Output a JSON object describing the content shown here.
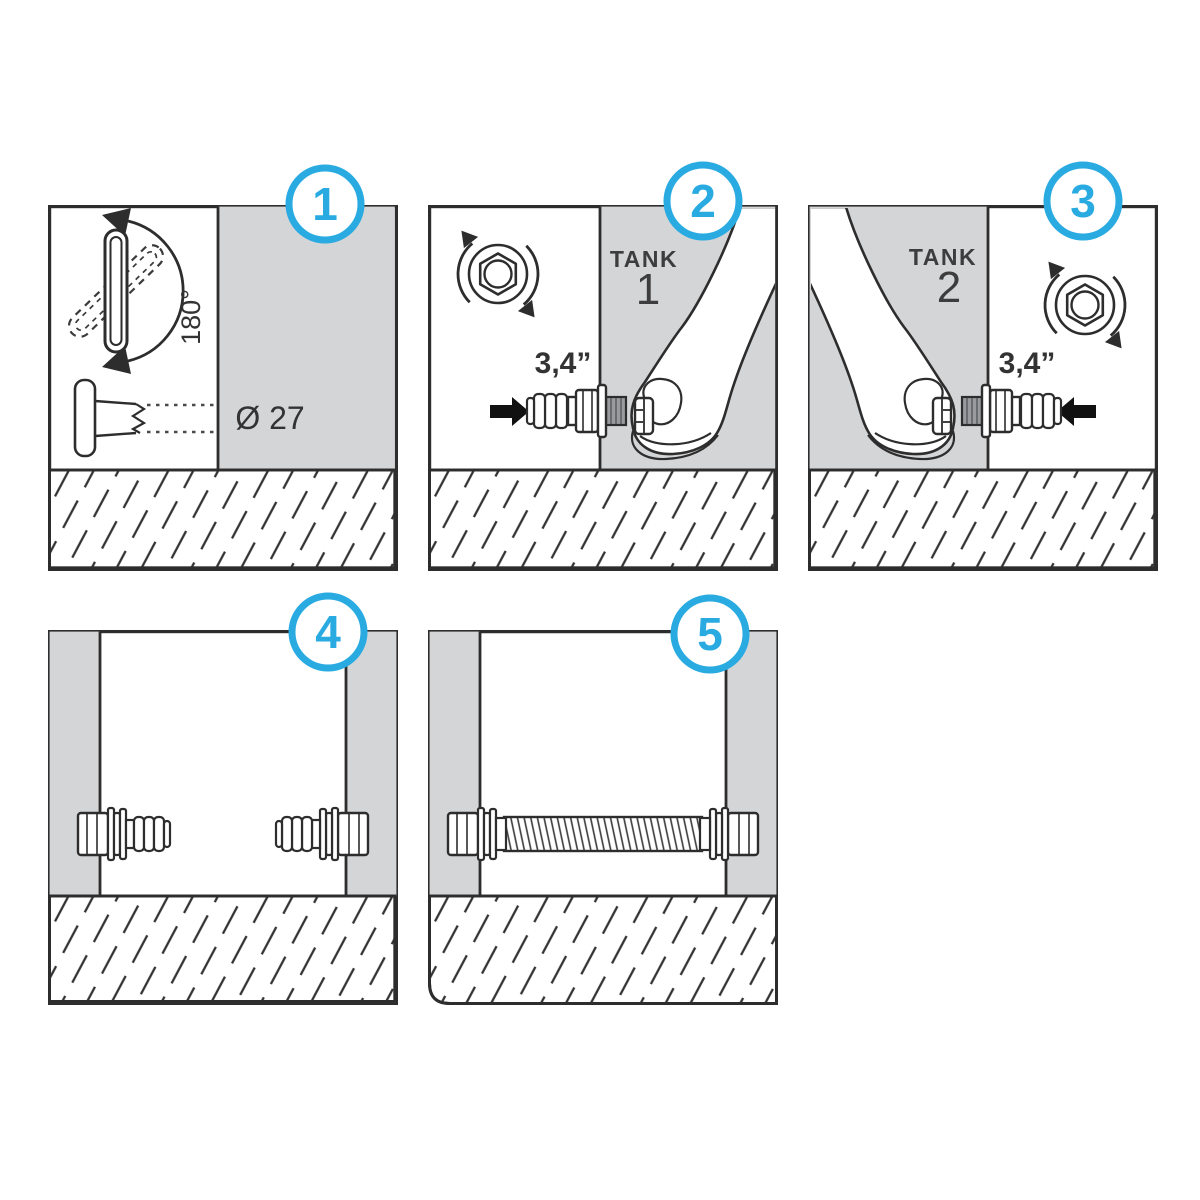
{
  "colors": {
    "accent": "#29abe2",
    "wall": "#d4d5d7",
    "outline": "#2d2d2d",
    "thread_fill": "#9a9b9e"
  },
  "panels": {
    "p1": {
      "badge": "1",
      "rotation_label": "180°",
      "hole_diameter_label": "Ø 27"
    },
    "p2": {
      "badge": "2",
      "tank_word": "TANK",
      "tank_number": "1",
      "fitting_size_label": "3,4”"
    },
    "p3": {
      "badge": "3",
      "tank_word": "TANK",
      "tank_number": "2",
      "fitting_size_label": "3,4”"
    },
    "p4": {
      "badge": "4"
    },
    "p5": {
      "badge": "5"
    }
  }
}
